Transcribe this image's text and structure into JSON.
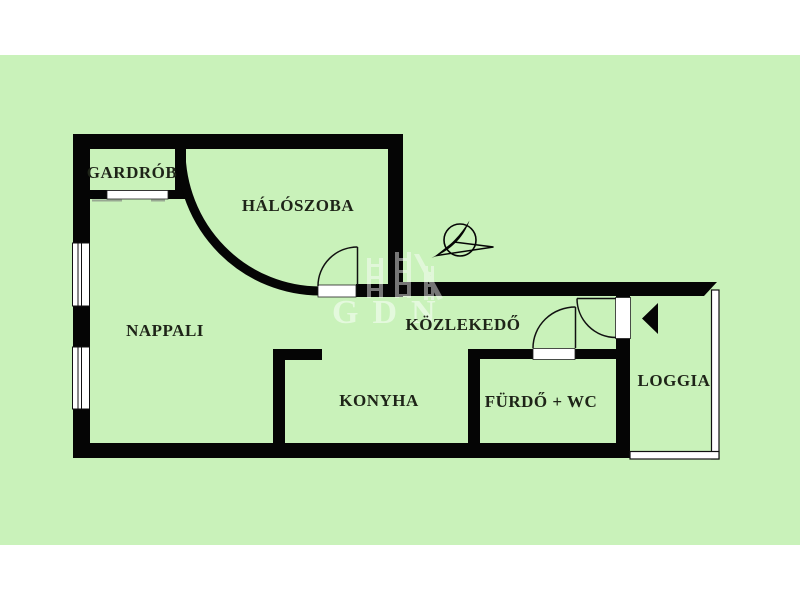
{
  "title": "apartment-floorplan",
  "colors": {
    "paper": "#ffffff",
    "plan_background": "#c9f2ba",
    "wall": "#050505",
    "label_text": "#1e2418",
    "watermark": "rgba(255,255,255,0.5)"
  },
  "rooms": {
    "gardrob": {
      "label": "GARDRÓB"
    },
    "haloszoba": {
      "label": "HÁLÓSZOBA"
    },
    "nappali": {
      "label": "NAPPALI"
    },
    "kozlekedo": {
      "label": "KÖZLEKEDŐ"
    },
    "konyha": {
      "label": "KONYHA"
    },
    "furdo_wc": {
      "label": "FÜRDŐ + WC"
    },
    "loggia": {
      "label": "LOGGIA"
    }
  },
  "icons": {
    "compass": "north-compass-icon",
    "entrance_arrow": "entrance-arrow-icon"
  },
  "watermark": {
    "text": "GDN"
  }
}
